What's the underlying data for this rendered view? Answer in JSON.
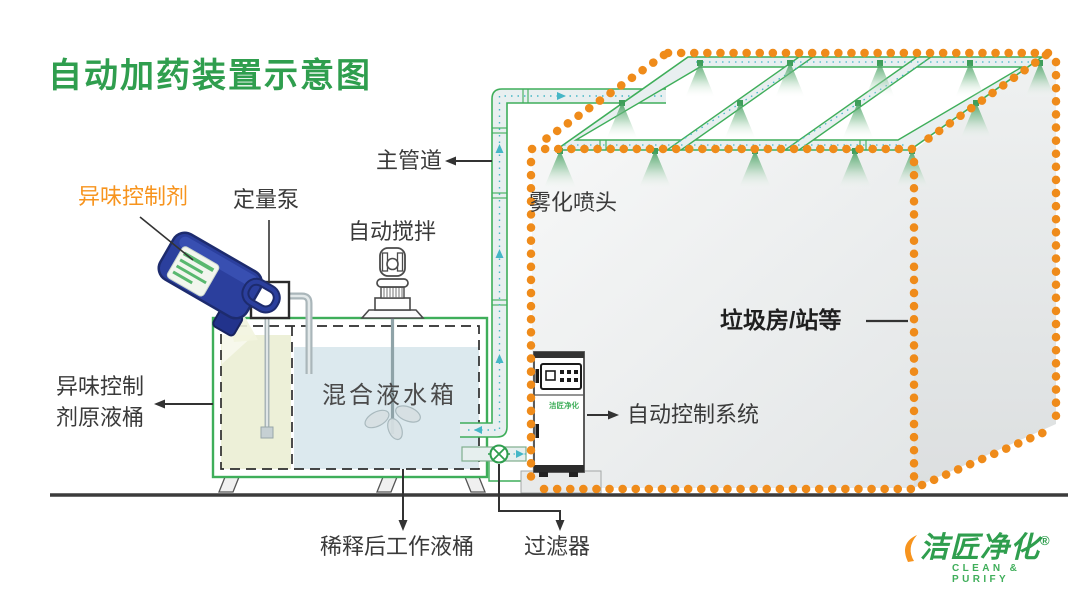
{
  "title": "自动加药装置示意图",
  "labels": {
    "odor_agent": "异味控制剂",
    "metering_pump": "定量泵",
    "auto_stir": "自动搅拌",
    "main_pipe": "主管道",
    "fog_nozzles": "雾化喷头",
    "garbage_room": "垃圾房/站等",
    "auto_control_system": "自动控制系统",
    "mixing_tank": "混合液水箱",
    "raw_drum_line1": "异味控制",
    "raw_drum_line2": "剂原液桶",
    "diluted_drum": "稀释后工作液桶",
    "filter": "过滤器"
  },
  "cabinet": {
    "logo": "洁匠净化"
  },
  "logo": {
    "name": "洁匠净化",
    "registered": "®",
    "tagline": "CLEAN & PURIFY"
  },
  "colors": {
    "title_green": "#2f9e4e",
    "pipe_green": "#3fae5a",
    "dot_orange": "#ef8b1a",
    "label_orange": "#f7941e",
    "flow_teal": "#45b6c6",
    "jug_blue": "#2b3f9d",
    "water_blue": "#dce9ee",
    "chemical_yellow": "#edf0d8",
    "building_gray": "#e9ebec"
  }
}
